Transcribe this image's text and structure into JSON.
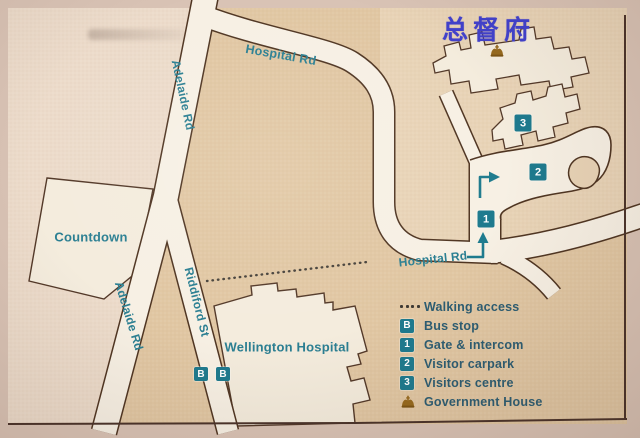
{
  "overlay_title": {
    "text": "总督府",
    "color": "#4141cc"
  },
  "map": {
    "road_labels": {
      "hospital_rd_top": "Hospital Rd",
      "hospital_rd_lower": "Hospital Rd",
      "adelaide_rd_upper": "Adelaide Rd",
      "adelaide_rd_lower": "Adelaide Rd",
      "riddiford_st": "Riddiford St"
    },
    "place_labels": {
      "countdown": "Countdown",
      "wellington_hospital": "Wellington Hospital"
    },
    "markers": {
      "bus_stop_1": "B",
      "bus_stop_2": "B",
      "gate": "1",
      "visitor_carpark": "2",
      "visitors_centre": "3"
    }
  },
  "legend": {
    "items": [
      {
        "icon": "walking-dots-icon",
        "label": "Walking access"
      },
      {
        "icon": "badge",
        "badge": "B",
        "label": "Bus stop"
      },
      {
        "icon": "badge",
        "badge": "1",
        "label": "Gate & intercom"
      },
      {
        "icon": "badge",
        "badge": "2",
        "label": "Visitor carpark"
      },
      {
        "icon": "badge",
        "badge": "3",
        "label": "Visitors centre"
      },
      {
        "icon": "crown-icon",
        "label": "Government House"
      }
    ]
  },
  "colors": {
    "badge_teal": "#1e7a8e",
    "map_label_teal": "#2b7f92",
    "legend_text": "#2d5d72",
    "road_outline": "#4f3522",
    "road_fill": "#f7f0e4",
    "title_blue": "#4141cc",
    "crown_gold": "#96691e",
    "map_base_tan": "#e1c7a3",
    "map_west_light": "#ecdbca",
    "map_grounds": "#e8d3b6"
  }
}
